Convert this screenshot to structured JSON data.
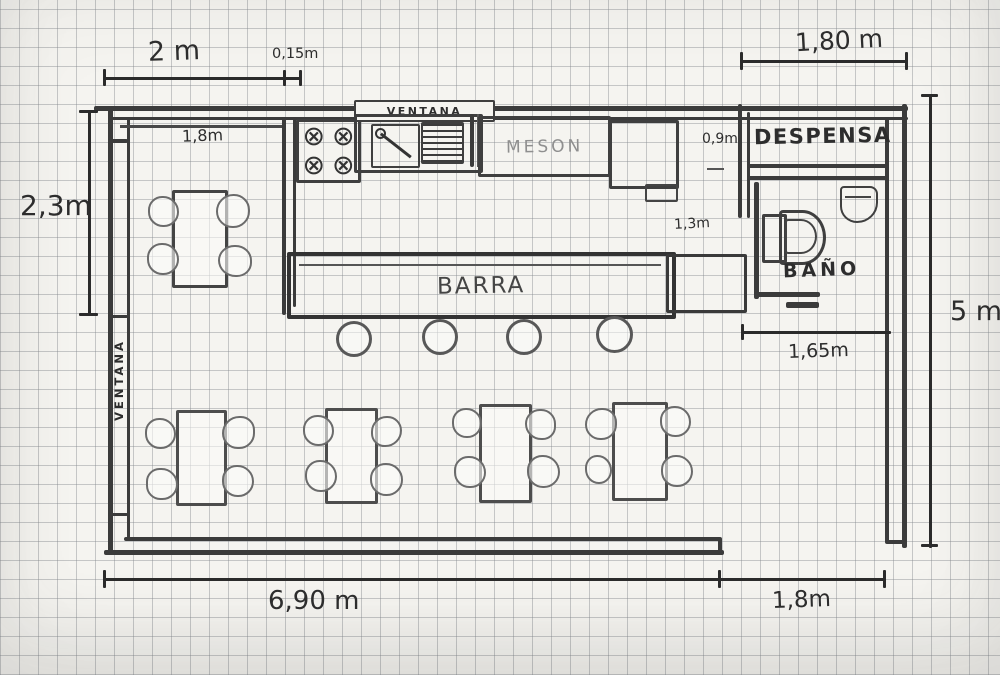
{
  "labels": {
    "window_top": "VENTANA",
    "window_left": "VENTANA",
    "counter": "MESON",
    "pantry": "DESPENSA",
    "bathroom": "BAÑO",
    "bar": "BARRA"
  },
  "dimensions": {
    "top_left": "2 m",
    "wall_thickness": "0,15m",
    "top_right": "1,80 m",
    "kitchen_inner": "1,8m",
    "kitchen_depth": "2,3m",
    "passage": "0,9m",
    "bath_offset": "1,3m",
    "bath_width": "1,65m",
    "total_height": "5 m",
    "bottom_main": "6,90 m",
    "bottom_right": "1,8m"
  },
  "icons": {
    "burner_glyph": "⊗"
  }
}
